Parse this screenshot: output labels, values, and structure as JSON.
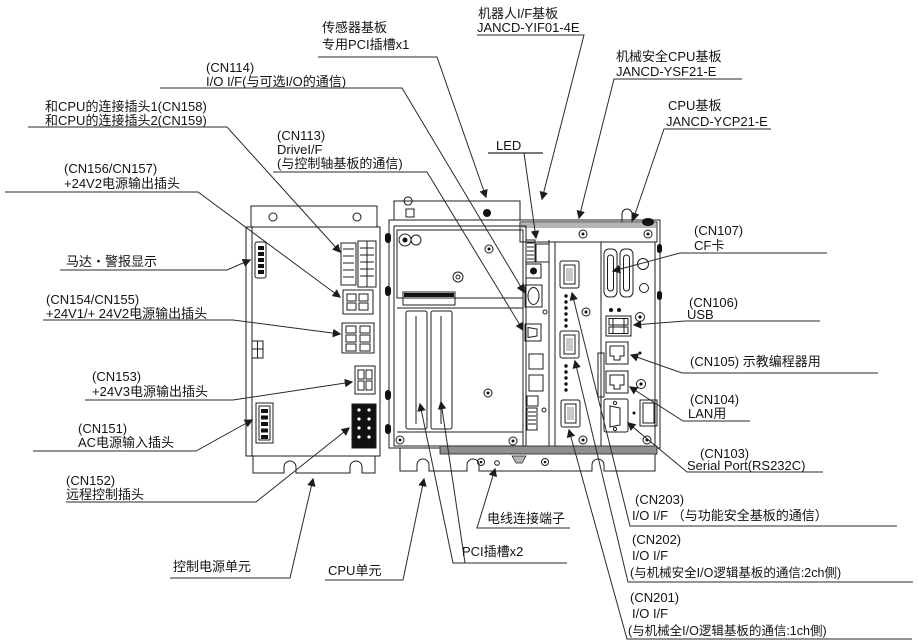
{
  "diagram": {
    "title_hint": "控制器单元连接器布局图",
    "colors": {
      "line": "#1c1c1c",
      "text": "#141414",
      "black_part": "#111111",
      "rail": "#8f8f8f"
    },
    "labels": {
      "sensor_pci": {
        "lines": [
          "传感器基板",
          "专用PCI插槽x1"
        ]
      },
      "robot_if": {
        "lines": [
          "机器人I/F基板",
          "JANCD-YIF01-4E"
        ]
      },
      "cn114": {
        "lines": [
          "(CN114)",
          "I/O I/F(与可选I/O的通信)"
        ]
      },
      "safety_cpu": {
        "lines": [
          "机械安全CPU基板",
          "JANCD-YSF21-E"
        ]
      },
      "cpu_board": {
        "lines": [
          "CPU基板",
          "JANCD-YCP21-E"
        ]
      },
      "led": {
        "lines": [
          "LED"
        ]
      },
      "cn158_159": {
        "lines": [
          "和CPU的连接插头1(CN158)",
          "和CPU的连接插头2(CN159)"
        ]
      },
      "cn113": {
        "lines": [
          "(CN113)",
          "DriveI/F",
          "(与控制轴基板的通信)"
        ]
      },
      "cn156_157": {
        "lines": [
          "(CN156/CN157)",
          "+24V2电源输出插头"
        ]
      },
      "motor_alarm": {
        "lines": [
          "马达・警报显示"
        ]
      },
      "cn154_155": {
        "lines": [
          "(CN154/CN155)",
          "+24V1/+ 24V2电源输出插头"
        ]
      },
      "cn153": {
        "lines": [
          "(CN153)",
          "+24V3电源输出插头"
        ]
      },
      "cn151": {
        "lines": [
          "(CN151)",
          "AC电源输入插头"
        ]
      },
      "cn152": {
        "lines": [
          "(CN152)",
          "远程控制插头"
        ]
      },
      "power_unit": {
        "lines": [
          "控制电源单元"
        ]
      },
      "cpu_unit": {
        "lines": [
          "CPU单元"
        ]
      },
      "pci_slots": {
        "lines": [
          "PCI插槽x2"
        ]
      },
      "wire_terminal": {
        "lines": [
          "电线连接端子"
        ]
      },
      "cn107": {
        "lines": [
          "(CN107)",
          "CF卡"
        ]
      },
      "cn106": {
        "lines": [
          "(CN106)",
          "USB"
        ]
      },
      "cn105": {
        "lines": [
          "(CN105) 示教编程器用"
        ]
      },
      "cn104": {
        "lines": [
          "(CN104)",
          "LAN用"
        ]
      },
      "cn103": {
        "lines": [
          "(CN103)",
          "Serial Port(RS232C)"
        ]
      },
      "cn203": {
        "lines": [
          "(CN203)",
          "I/O I/F （与功能安全基板的通信）"
        ]
      },
      "cn202": {
        "lines": [
          "(CN202)",
          "I/O I/F",
          "(与机械安全I/O逻辑基板的通信:2ch側)"
        ]
      },
      "cn201": {
        "lines": [
          "(CN201)",
          "I/O I/F",
          "(与机械全I/O逻辑基板的通信:1ch側)"
        ]
      }
    }
  }
}
